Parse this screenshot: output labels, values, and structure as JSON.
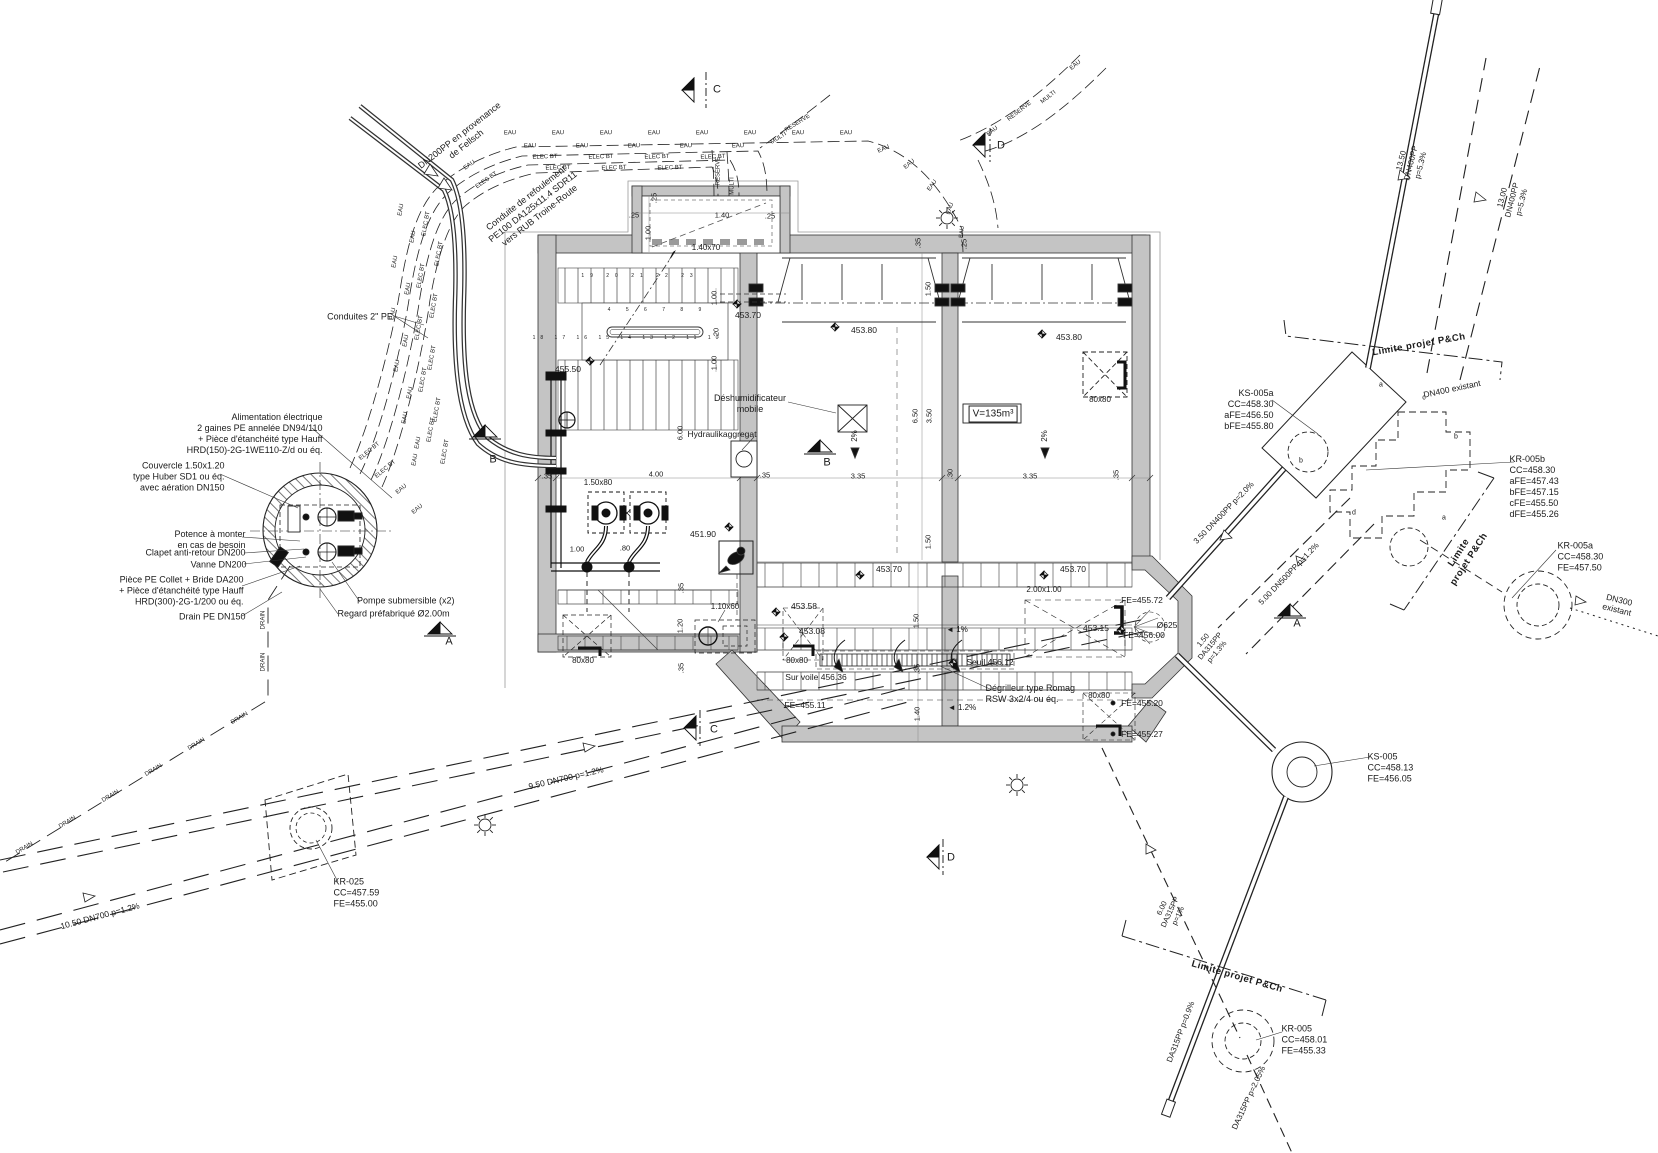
{
  "notes": {
    "dn200_provenance": "DN200PP en provenance\nde Fellsch",
    "conduite_refoulement": "Conduite de refoulement\nPE100 DA125x11.4 SDR11\nvers RUB Troine-Route",
    "conduites_2pe": "Conduites 2\" PE",
    "alimentation": "Alimentation électrique\n2 gaines PE annelée DN94/110\n+ Pièce d'étanchéité type Hauff\nHRD(150)-2G-1WE110-Z/d ou éq.",
    "couvercle": "Couvercle 1.50x1.20\ntype Huber SD1 ou éq.\navec aération DN150",
    "potence": "Potence à monter\nen cas de besoin",
    "clapet": "Clapet anti-retour DN200",
    "vanne": "Vanne DN200",
    "piece_pe": "Pièce PE Collet + Bride DA200\n+ Pièce d'étanchéité type Hauff\nHRD(300)-2G-1/200 ou éq.",
    "drain_pe": "Drain PE DN150",
    "pompe_submersible": "Pompe submersible (x2)",
    "regard_prefab": "Regard préfabriqué Ø2.00m",
    "deshumidificateur": "Déshumidificateur\nmobile",
    "hydraulikaggregat": "Hydraulikaggregat",
    "degrilleur": "Dégrilleur type Romag\nRSW 3x2/4 ou éq.",
    "volume": "V=135m³"
  },
  "structures": {
    "ks005a": "KS-005a\nCC=458.30\naFE=456.50\nbFE=455.80",
    "kr005b": "KR-005b\nCC=458.30\naFE=457.43\nbFE=457.15\ncFE=455.50\ndFE=455.26",
    "kr005a": "KR-005a\nCC=458.30\nFE=457.50",
    "ks005": "KS-005\nCC=458.13\nFE=456.05",
    "kr005": "KR-005\nCC=458.01\nFE=455.33",
    "kr025": "KR-025\nCC=457.59\nFE=455.00"
  },
  "pipes": {
    "dn400_1350": "13.50\nDN400PP\np=5.3%",
    "dn400_1300": "13.00\nDN400PP\np=5.3%",
    "dn400_350": "3.50  DN400PP  p=2.0%",
    "dn500_500": "5.00  DN500PP  p=1.2%",
    "da315_150": "1.50\nDA315PP\np=1.3%",
    "da315_600": "6.00\nDA315PP\np=1%",
    "da315_09": "DA315PP  p=0.9%",
    "da315_205": "DA315PP  p=2.05%",
    "dn700_950": "9.50 DN700 p=1.2%",
    "dn700_1050": "10.50 DN700 p=1.2%",
    "dn300_exist": "DN300 existant",
    "dn400_exist": "DN400 existant",
    "limite": "Limite projet P&Ch",
    "limite2": "Limite\nprojet P&Ch",
    "eau": "EAU",
    "elec": "ELEC BT",
    "reserve": "RESERVE",
    "multi": "MULTI",
    "drain": "DRAIN"
  },
  "levels": {
    "l45550": "455.50",
    "l45370a": "453.70",
    "l45380a": "453.80",
    "l45380b": "453.80",
    "l45190": "451.90",
    "l45370b": "453.70",
    "l45370c": "453.70",
    "l45358": "453.58",
    "l45308": "453.08",
    "l45315": "453.15",
    "seuil": "Seuil 456.12",
    "survoile": "Sur voile 456.36",
    "fe45511": "FE=455.11",
    "fe45572": "FE=455.72",
    "fe45600": "FE=456.00",
    "o625": "Ø625",
    "fe45520": "FE=455.20",
    "fe45527": "FE=455.27"
  },
  "dims": {
    "d20": ".20",
    "d25": ".25",
    "d30": ".30",
    "d35": ".35",
    "d80": ".80",
    "d100": "1.00",
    "d120": "1.20",
    "d140": "1.40",
    "d150": "1.50",
    "d335": "3.35",
    "d350": "3.50",
    "d400": "4.00",
    "d600": "6.00",
    "d650": "6.50",
    "d14070": "1.40x70",
    "d15080": "1.50x80",
    "d11060": "1.10x60",
    "d8080": "80x80",
    "d200100": "2.00x1.00"
  },
  "slopes": {
    "s2": "2%",
    "s1": "◄ 1%",
    "s12": "◄ 1.2%"
  },
  "sections": {
    "a": "A",
    "b": "B",
    "c": "C",
    "d": "D"
  },
  "letters": {
    "a": "a",
    "b": "b",
    "c": "c",
    "d": "d"
  },
  "steps": {
    "top": "19  20  21  22  23",
    "mid": "4  5  6  7  8  9",
    "bottom": "18  17  16  15  14  13  12  11  10"
  }
}
